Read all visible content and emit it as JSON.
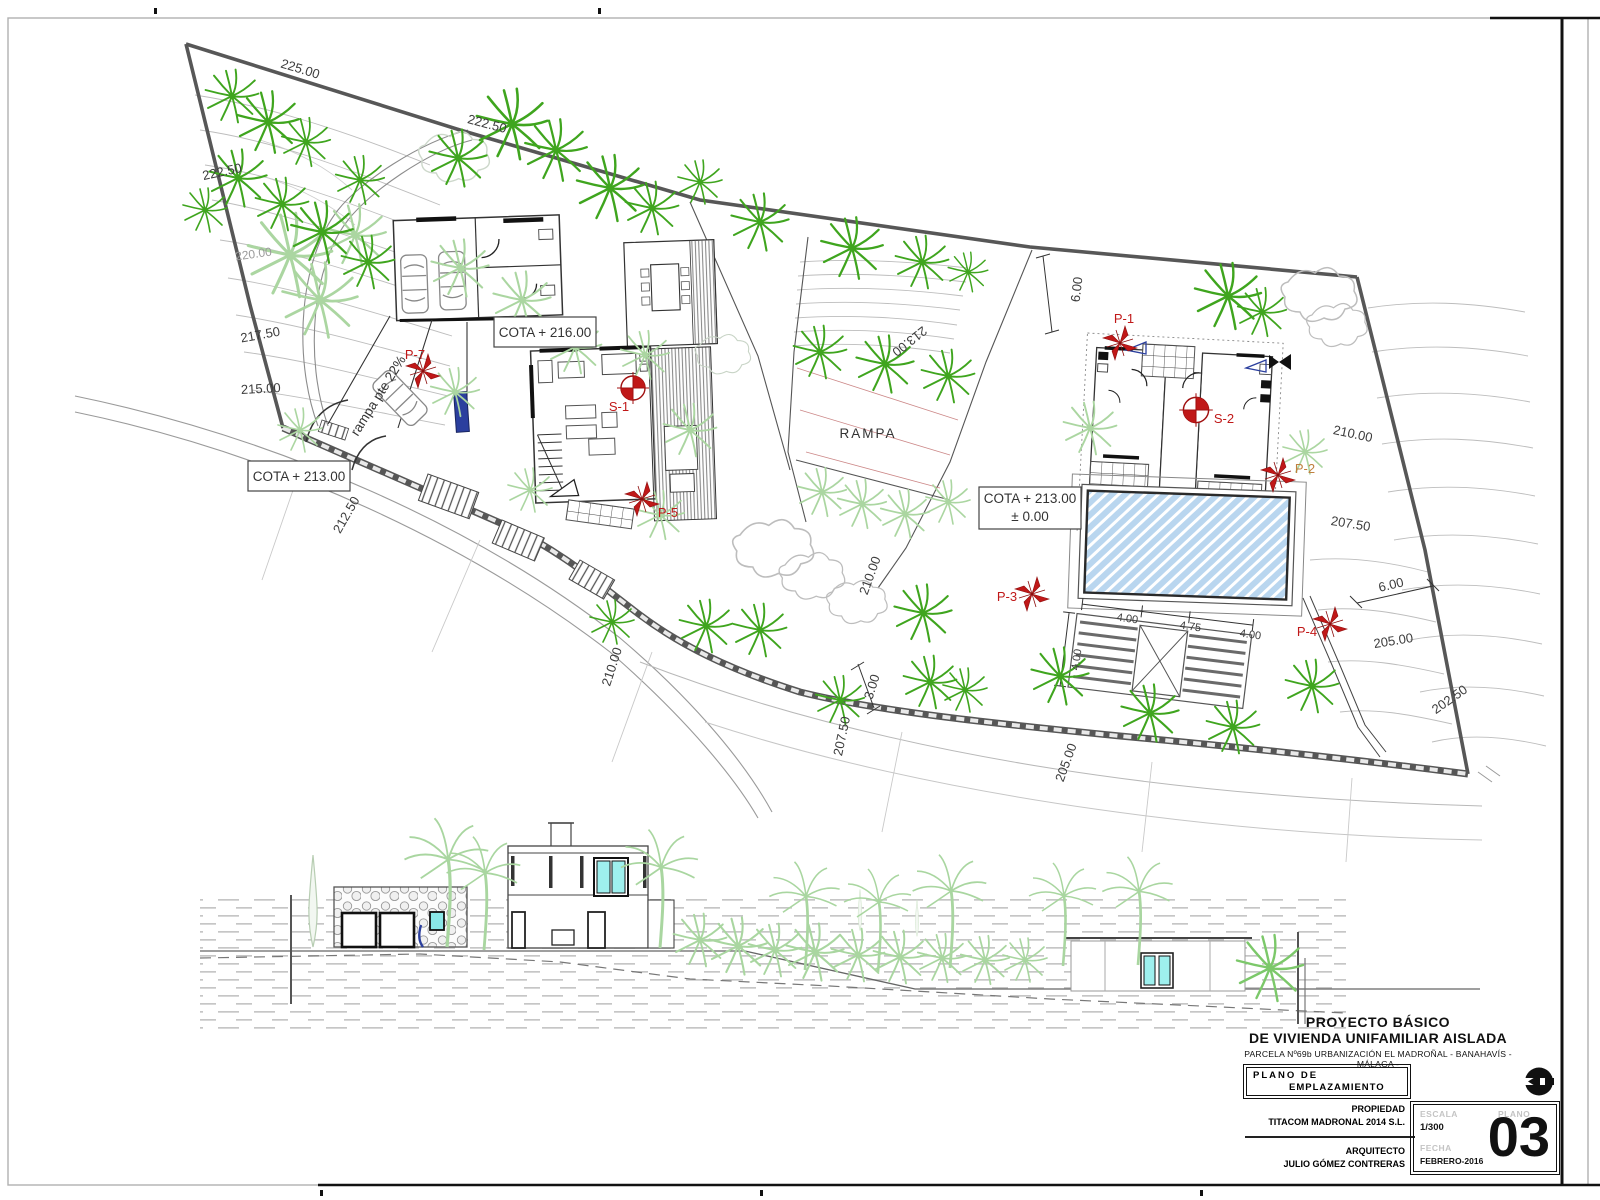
{
  "site_plan": {
    "contour_labels": [
      "225.00",
      "222.50",
      "222.50",
      "220.00",
      "217.50",
      "215.00",
      "212.50",
      "210.00",
      "207.50",
      "205.00",
      "210.00",
      "213.00",
      "6.00",
      "210.00",
      "207.50",
      "6.00",
      "205.00",
      "202.50",
      "3.00"
    ],
    "dim_labels": [
      "4.00",
      "4.75",
      "4.00",
      "4.00"
    ],
    "cota_main": "COTA + 216.00",
    "cota_entrance": "COTA + 213.00",
    "cota_pool_line1": "COTA + 213.00",
    "cota_pool_line2": "± 0.00",
    "ramp_slope_label": "rampa pte 22%",
    "rampa_label": "RAMPA",
    "markers": {
      "p1": "P-1",
      "p2": "P-2",
      "p3": "P-3",
      "p4": "P-4",
      "p5": "P-5",
      "p7": "P-7",
      "s1": "S-1",
      "s2": "S-2"
    },
    "colors": {
      "marker_red": "#c01818",
      "pool_blue": "#b9d6ef",
      "tree_green": "#3fa51e",
      "boundary_gray": "#575757",
      "accent_blue": "#2b3f9e",
      "window_cyan": "#8ae8e8"
    }
  },
  "title_block": {
    "project_line1": "PROYECTO BÁSICO",
    "project_line2": "DE VIVIENDA UNIFAMILIAR AISLADA",
    "parcel_line": "PARCELA Nº69b URBANIZACIÓN EL MADROÑAL - BANAHAVÍS - MÁLAGA -",
    "plan_title_line1": "PLANO DE",
    "plan_title_line2": "EMPLAZAMIENTO",
    "owner_label": "PROPIEDAD",
    "owner_value": "TITACOM MADRONAL 2014 S.L.",
    "architect_label": "ARQUITECTO",
    "architect_value": "JULIO GÓMEZ CONTRERAS",
    "scale_label": "ESCALA",
    "scale_value": "1/300",
    "plan_label": "PLANO",
    "plan_number": "03",
    "date_label": "FECHA",
    "date_value": "FEBRERO-2016"
  }
}
